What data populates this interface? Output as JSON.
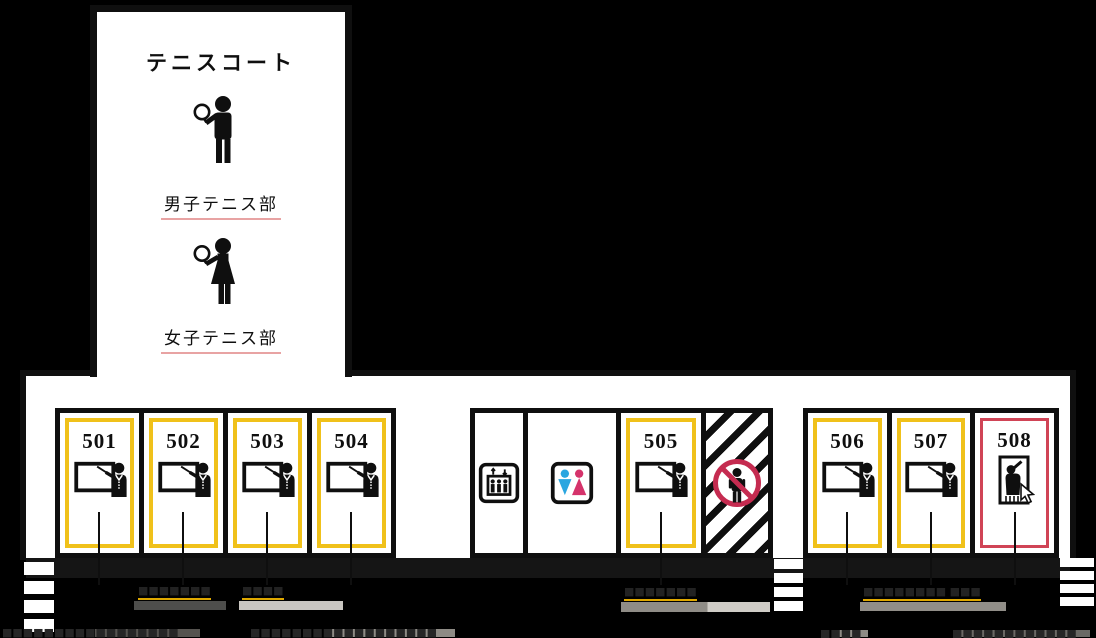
{
  "map_title": "5th-floor school map",
  "tennis_court": {
    "title": "テニスコート",
    "mens_club_label": "男子テニス部",
    "womens_club_label": "女子テニス部"
  },
  "rooms": {
    "r501": "501",
    "r502": "502",
    "r503": "503",
    "r504": "504",
    "r505": "505",
    "r506": "506",
    "r507": "507",
    "r508": "508"
  },
  "facility_icons": [
    "elevator-icon",
    "restroom-icon",
    "no-entry-icon",
    "door-entry-icon"
  ],
  "labels": {
    "under_502": "■■■■■■■",
    "under_503": "■■■■",
    "under_505": "■■■■■■■",
    "under_506_507": "■■■■■■■■ ■■■",
    "bottom_501": "■■■■■■■■■■■■■■■■■",
    "bottom_504": "■■■■■■■■■■■■■■■■■■",
    "bottom_506": "■■■■",
    "bottom_508": "■■■■■■■■■■■■"
  },
  "colors": {
    "background": "#000000",
    "ink": "#0f0f0f",
    "room_border_yellow": "#f0c11a",
    "room_border_red": "#d04456",
    "underline_yellow": "#dfa800",
    "underline_red": "#c42a3c",
    "underline_pink": "#e8a3a3",
    "restroom_male_blue": "#2aa6e0",
    "restroom_female_pink": "#d5336b",
    "no_entry_red": "#c52b50"
  }
}
